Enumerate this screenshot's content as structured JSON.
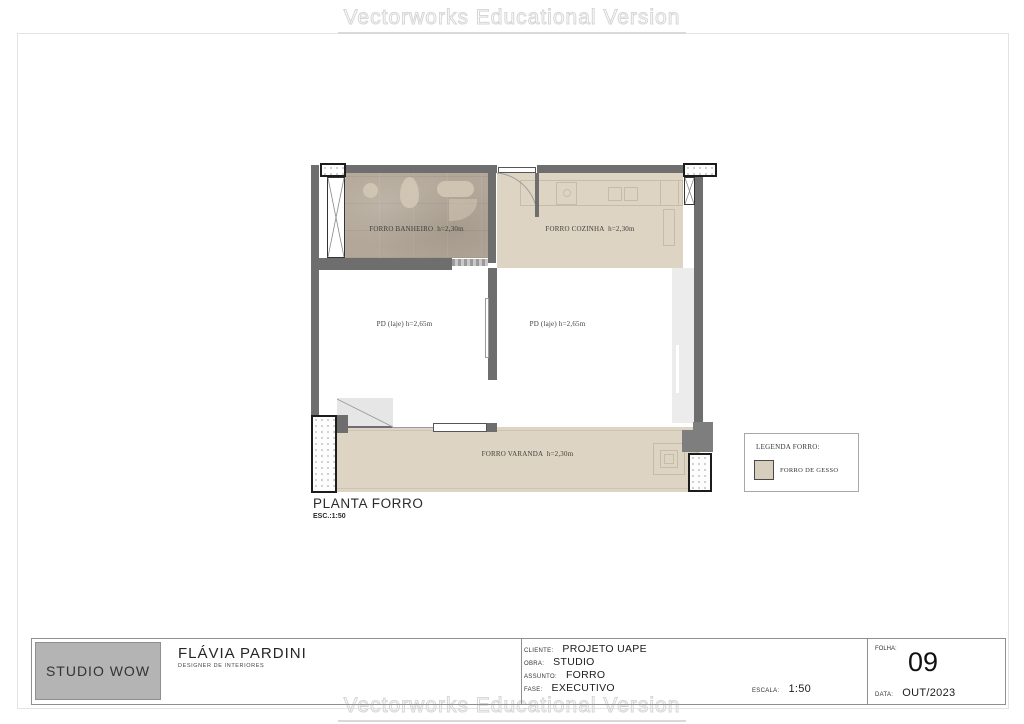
{
  "watermark": {
    "text": "Vectorworks Educational Version"
  },
  "plan": {
    "title": "PLANTA FORRO",
    "scale_note": "ESC.:1:50",
    "rooms": [
      {
        "id": "forro-banheiro",
        "label": "FORRO BANHEIRO  h=2,30m"
      },
      {
        "id": "forro-cozinha",
        "label": "FORRO COZINHA  h=2,30m"
      },
      {
        "id": "pd-laje-left",
        "label": "PD (laje) h=2,65m"
      },
      {
        "id": "pd-laje-right",
        "label": "PD (laje) h=2,65m"
      },
      {
        "id": "forro-varanda",
        "label": "FORRO VARANDA  h=2,30m"
      }
    ],
    "colors": {
      "forro_gesso_fill": "#ded4c4",
      "bathroom_texture_fill": "#b2a798",
      "wall": "#6e6e6e",
      "window_glass": "#ececec"
    }
  },
  "legend": {
    "title": "LEGENDA FORRO:",
    "items": [
      {
        "label": "FORRO DE GESSO",
        "swatch_color": "#d8cebd"
      }
    ]
  },
  "title_block": {
    "company": "STUDIO WOW",
    "designer_name": "FLÁVIA PARDINI",
    "designer_title": "DESIGNER DE INTERIORES",
    "rows": [
      {
        "label": "CLIENTE:",
        "value": "PROJETO UAPE"
      },
      {
        "label": "OBRA:",
        "value": "STUDIO"
      },
      {
        "label": "ASSUNTO:",
        "value": "FORRO"
      },
      {
        "label": "FASE:",
        "value": "EXECUTIVO"
      }
    ],
    "escala": {
      "label": "ESCALA:",
      "value": "1:50"
    },
    "folha": {
      "label": "FOLHA:",
      "value": "09"
    },
    "data": {
      "label": "DATA:",
      "value": "OUT/2023"
    }
  }
}
